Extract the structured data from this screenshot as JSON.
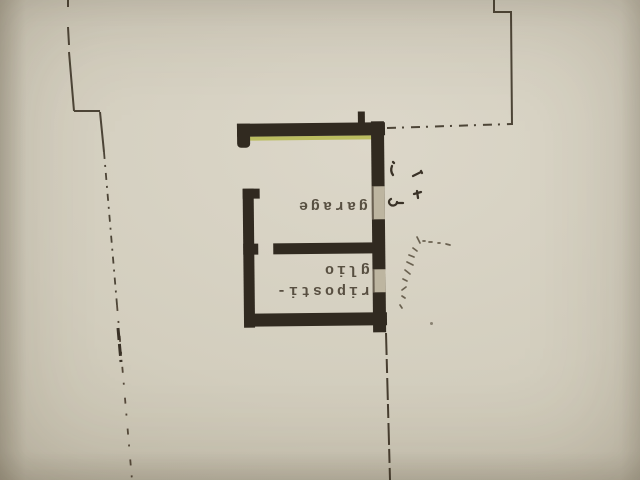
{
  "plan": {
    "rooms": [
      {
        "label": "garage"
      },
      {
        "label_lines": [
          "riposti-",
          "glio"
        ]
      }
    ]
  },
  "colors": {
    "paper": "#d3cebe",
    "wall_ink": "#312a20",
    "line_ink": "#4d4537",
    "highlight": "#b5b94e"
  }
}
